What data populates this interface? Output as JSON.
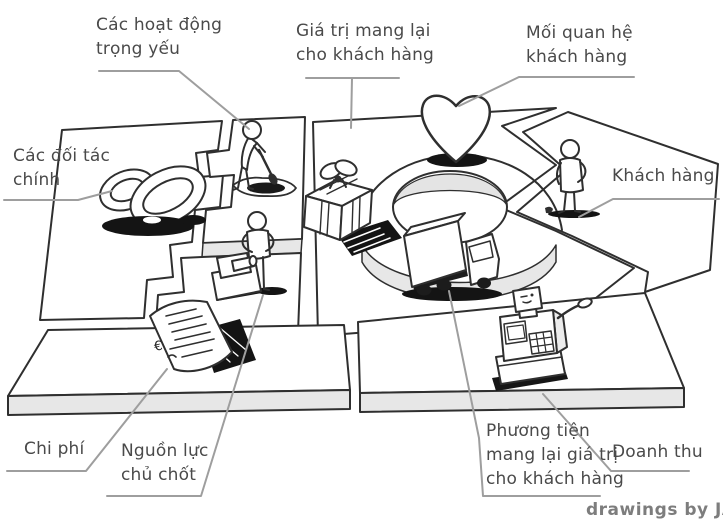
{
  "canvas": {
    "credit": "drawings by JAM",
    "currency_symbol": "€",
    "labels": {
      "key_activities": "Các hoạt động\ntrọng yếu",
      "value_proposition": "Giá trị mang lại\ncho khách hàng",
      "customer_relationships": "Mối quan hệ\nkhách hàng",
      "key_partners": "Các đối tác\nchính",
      "customers": "Khách hàng",
      "costs": "Chi phí",
      "key_resources": "Nguồn lực\nchủ chốt",
      "channels": "Phương tiện\nmang lại giá trị\ncho khách hàng",
      "revenue": "Doanh thu"
    },
    "illustrations": {
      "key_partners": "interlocked-rings-icon",
      "key_activities": "person-digging-icon",
      "key_resources": "person-with-machine-icon",
      "value_proposition": "gift-box-icon",
      "customer_relationships": "heart-icon",
      "customers": "standing-person-icon",
      "channels": "delivery-truck-icon",
      "revenue": "cash-register-icon",
      "costs": "euro-receipt-icon",
      "flow": "circular-arrow-ring"
    },
    "colors": {
      "background": "#ffffff",
      "ink": "#2f2f2f",
      "leader_line": "#9e9e9e",
      "label_text": "#4a4a4a",
      "credit_text": "#7d7d7d",
      "slab_shade": "#e7e7e7",
      "shadow": "#141414"
    }
  }
}
